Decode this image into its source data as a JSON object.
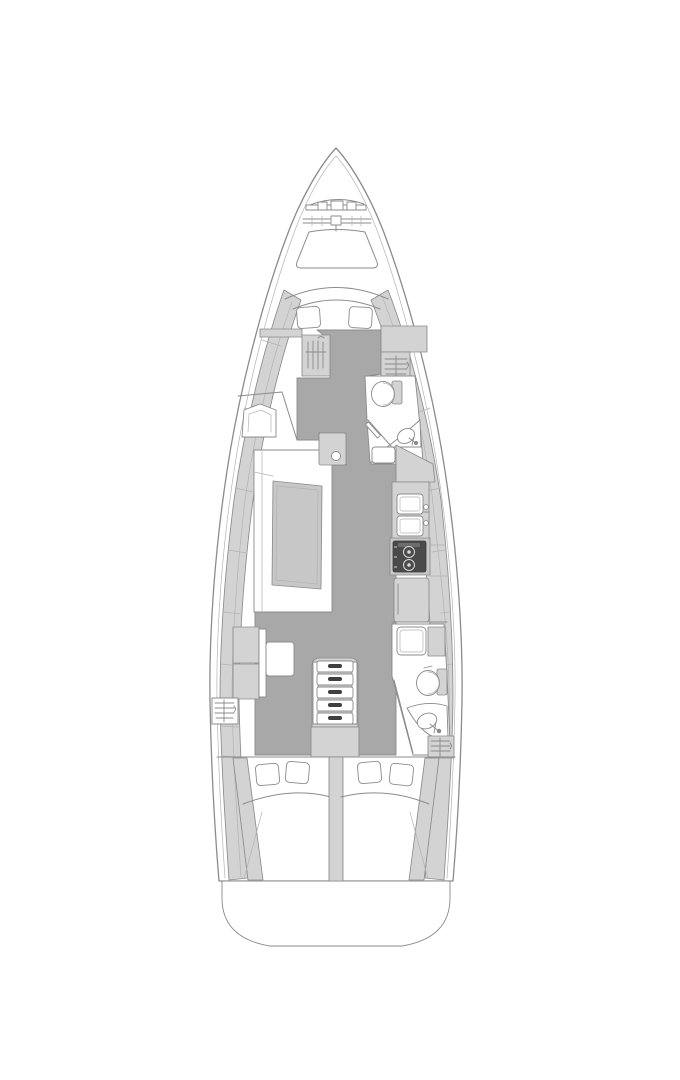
{
  "figure": {
    "kind": "floor-plan",
    "subject": "sailing-yacht interior layout, top-down view, bow at top",
    "background": "#ffffff"
  },
  "palette": {
    "white": "#ffffff",
    "floor": "#a8a8a8",
    "furniture_light": "#d3d3d3",
    "furniture_mid": "#c7c7c7",
    "appliance_dark": "#4a4a4a",
    "outline": "#8b8b8b",
    "outline_light": "#b3b3b3"
  }
}
